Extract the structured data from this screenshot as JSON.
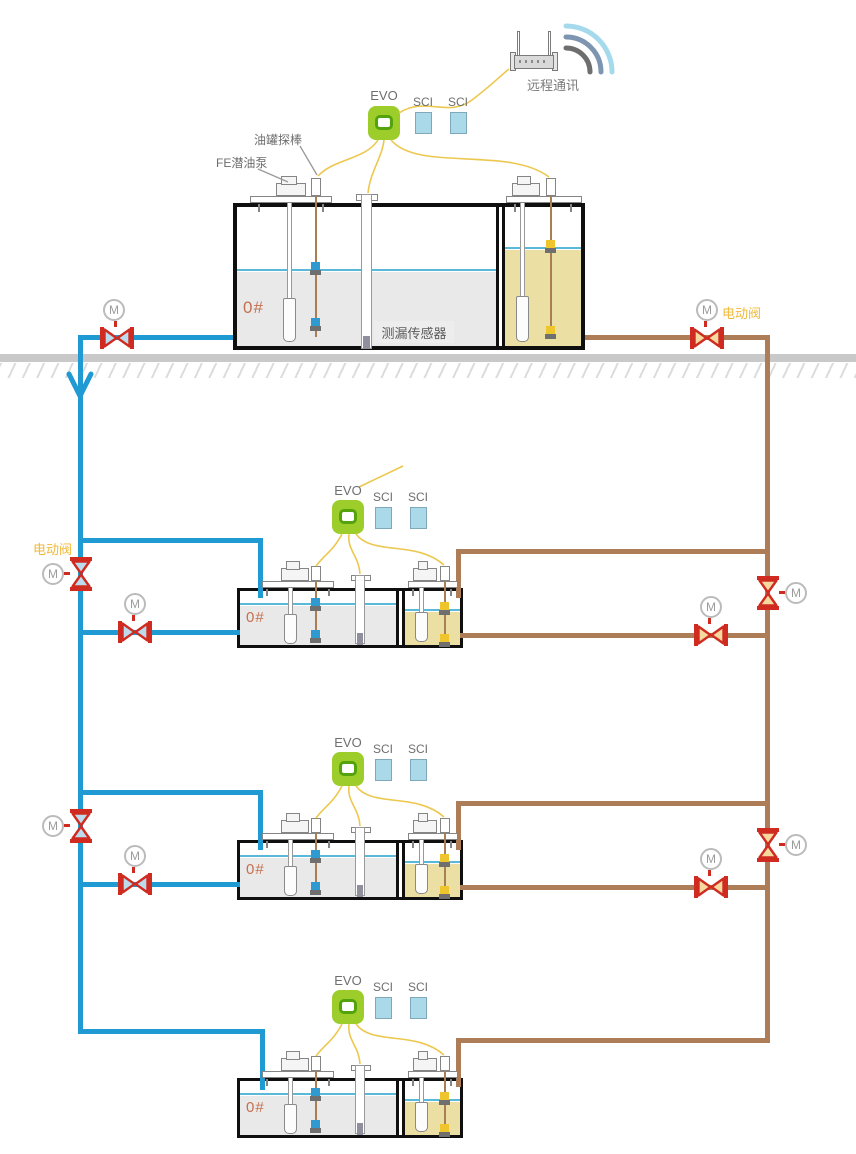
{
  "labels": {
    "remote_comm": "远程通讯",
    "evo": "EVO",
    "sci": "SCI",
    "probe": "油罐探棒",
    "pump": "FE潜油泵",
    "leak_sensor": "测漏传感器",
    "electric_valve": "电动阀",
    "motor": "M",
    "grade": "0#"
  },
  "colors": {
    "supply_pipe_blue": "#1f9ad3",
    "return_pipe_brown": "#ad7d58",
    "signal_cable_yellow": "#ecc84f",
    "valve_red": "#cf2b20",
    "valve_tri_blue": "#bcdcee",
    "valve_tri_tan": "#f6d99f",
    "evo_green": "#9ccd2a",
    "sci_blue": "#aad9e9",
    "diesel_fill_gray": "#e9e9e9",
    "gasoline_fill_tan": "#ecdfa4",
    "liquid_level_blue": "#5ab9d9",
    "ground_gray": "#c9c9c9",
    "grade_text": "#c4704e",
    "valve_label_text": "#f0b93a"
  }
}
